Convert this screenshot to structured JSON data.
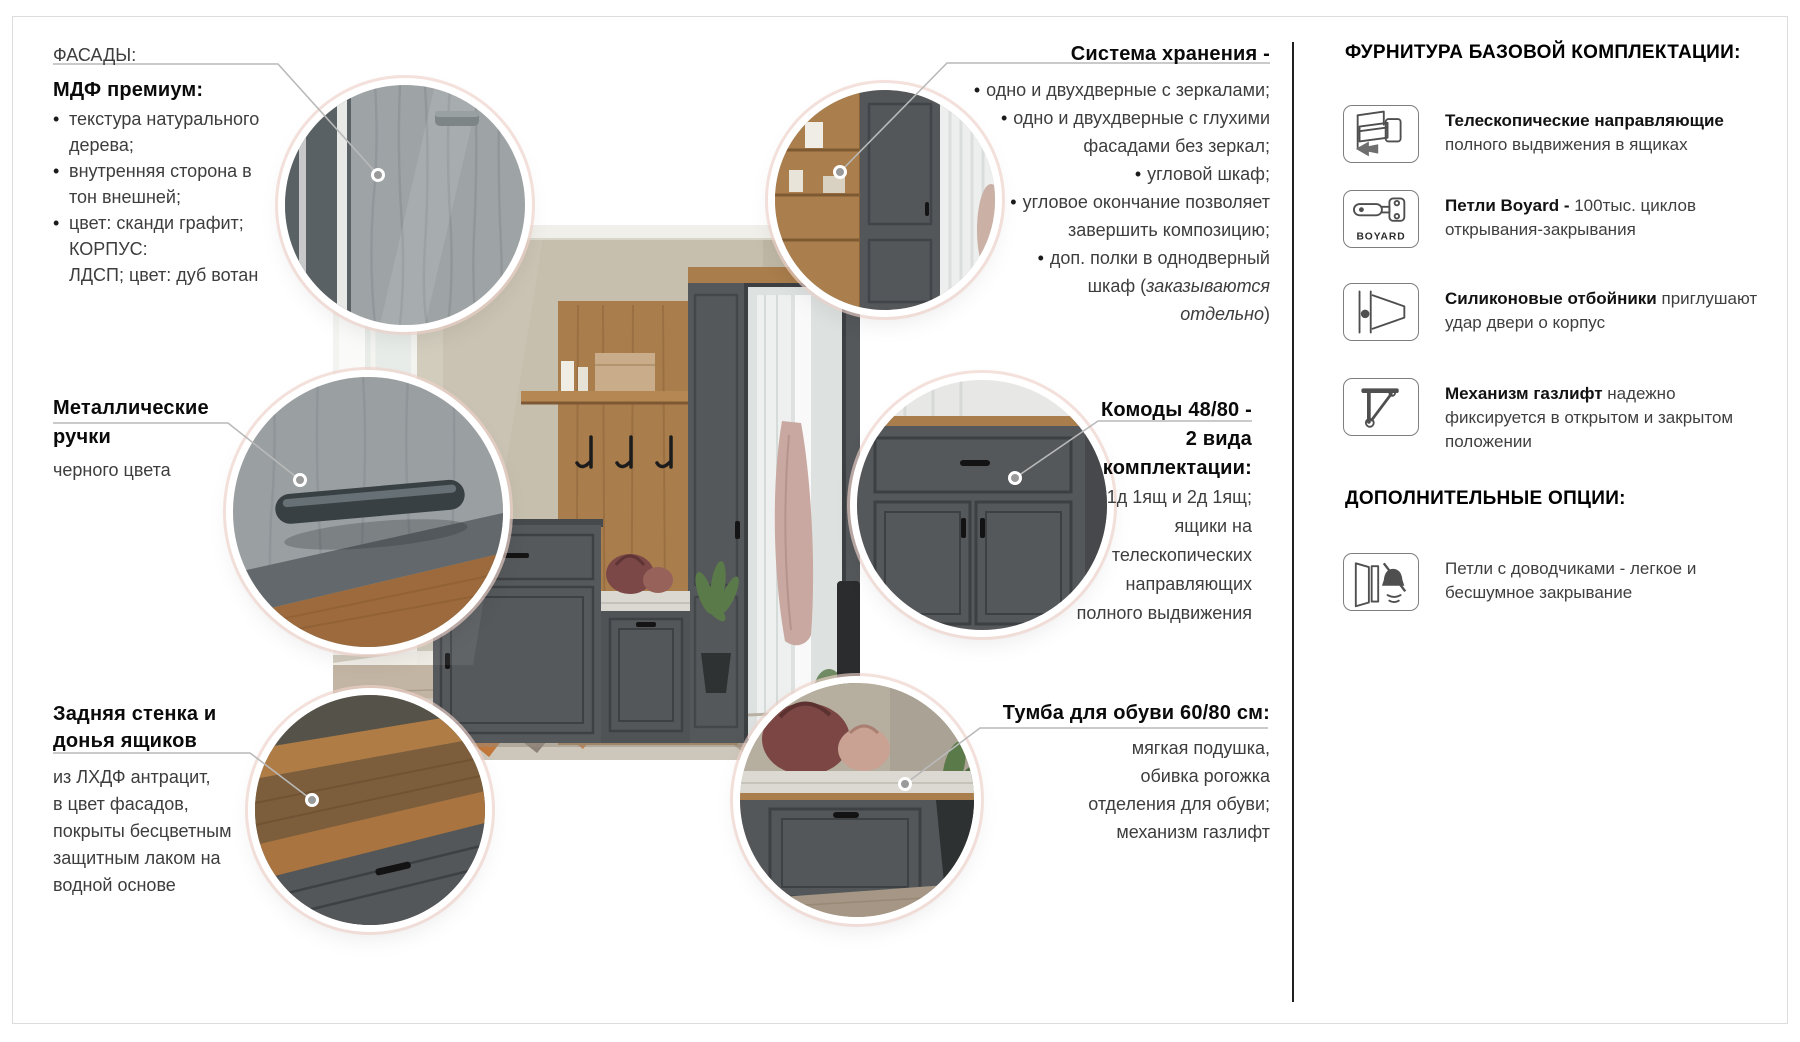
{
  "ui": {
    "bullet": "•"
  },
  "colors": {
    "graphite_facade": "#55585b",
    "oak_votan": "#a97d4c",
    "wall_beige": "#c6bfae",
    "leader_line": "#b9b9b9",
    "ring_white": "#ffffff",
    "ring_pink": "#eed1c9"
  },
  "callouts": {
    "facades": {
      "eyebrow": "ФАСАДЫ:",
      "title": "МДФ премиум:",
      "lines": [
        {
          "b": true,
          "t": "текстура натурального"
        },
        {
          "b": false,
          "t": "дерева;"
        },
        {
          "b": true,
          "t": "внутренняя сторона в"
        },
        {
          "b": false,
          "t": "тон внешней;"
        },
        {
          "b": true,
          "t": "цвет: сканди графит;"
        },
        {
          "b": false,
          "t": "КОРПУС:"
        },
        {
          "b": false,
          "t": "ЛДСП; цвет: дуб вотан"
        }
      ]
    },
    "storage": {
      "title": "Система хранения -",
      "lines": [
        {
          "b": true,
          "t": "одно и двухдверные с зеркалами;"
        },
        {
          "b": true,
          "t": "одно и двухдверные с глухими"
        },
        {
          "b": false,
          "t": "фасадами без зеркал;"
        },
        {
          "b": true,
          "t": "угловой шкаф;"
        },
        {
          "b": true,
          "t": "угловое окончание позволяет"
        },
        {
          "b": false,
          "t": "завершить композицию;"
        },
        {
          "b": true,
          "t": "доп. полки в однодверный"
        },
        {
          "b": false,
          "t": "шкаф (",
          "it": "заказываются"
        },
        {
          "b": false,
          "it2": "отдельно",
          "t2": ")"
        }
      ]
    },
    "handles": {
      "title_line1": "Металлические",
      "title_line2": "ручки",
      "subtitle": "черного цвета"
    },
    "chests": {
      "title_lines": [
        "Комоды 48/80 -",
        "2 вида",
        "комплектации:"
      ],
      "lines": [
        "1д 1ящ и 2д 1ящ;",
        "ящики на",
        "телескопических",
        "направляющих",
        "полного выдвижения"
      ]
    },
    "back_panel": {
      "title_lines": [
        "Задняя стенка и",
        "донья ящиков"
      ],
      "lines": [
        "из ЛХДФ антрацит,",
        "в цвет фасадов,",
        "покрыты бесцветным",
        "защитным лаком на",
        "водной основе"
      ]
    },
    "shoe_cabinet": {
      "title": "Тумба для обуви 60/80 см:",
      "lines": [
        "мягкая подушка,",
        "обивка рогожка",
        "отделения для обуви;",
        "механизм газлифт"
      ]
    }
  },
  "sidebar": {
    "base_title": "ФУРНИТУРА БАЗОВОЙ КОМПЛЕКТАЦИИ:",
    "items": [
      {
        "icon": "drawer-slides-icon",
        "name": "Телескопические направляющие",
        "desc": "полного выдвижения в ящиках"
      },
      {
        "icon": "boyard-hinge-icon",
        "brand": "BOYARD",
        "name": "Петли Boyard -",
        "desc": "100тыс. циклов открывания-закрывания"
      },
      {
        "icon": "silicone-bumper-icon",
        "name": "Силиконовые отбойники",
        "desc": "приглушают удар двери о корпус"
      },
      {
        "icon": "gas-lift-icon",
        "name": "Механизм газлифт",
        "desc": "надежно фиксируется в открытом и закрытом положении"
      }
    ],
    "options_title": "ДОПОЛНИТЕЛЬНЫЕ ОПЦИИ:",
    "options": [
      {
        "icon": "soft-close-hinge-icon",
        "text": "Петли с доводчиками - легкое и бесшумное закрывание"
      }
    ]
  }
}
